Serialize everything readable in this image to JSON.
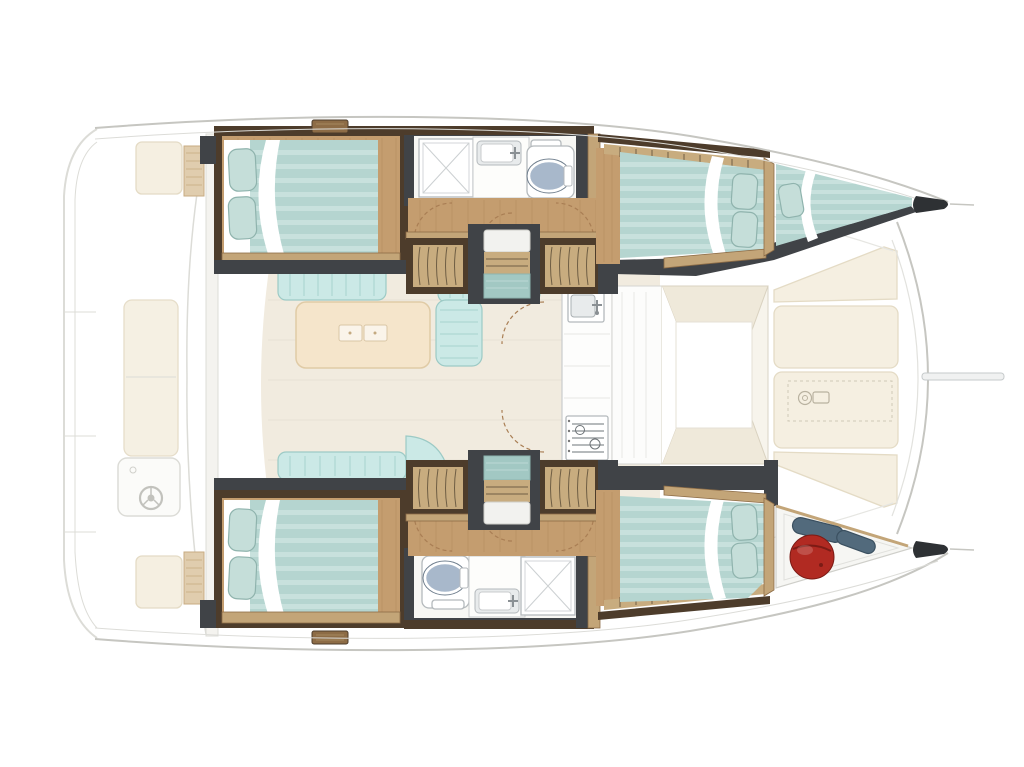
{
  "canvas": {
    "width": 1024,
    "height": 767,
    "viewBox": "0 0 1024 767",
    "background": "#ffffff"
  },
  "diagram": {
    "kind": "boat-floor-plan",
    "vessel_type": "catamaran",
    "bow_direction": "right",
    "stern_direction": "left",
    "layout": {
      "port_hull": [
        "aft-double-cabin",
        "bathroom-shower-sink-toilet",
        "stairwell",
        "forward-double-cabin",
        "bow-berth"
      ],
      "starboard_hull": [
        "aft-double-cabin",
        "bathroom-toilet-sink-shower",
        "stairwell",
        "forward-double-cabin",
        "bow-locker-with-fenders"
      ],
      "bridge_deck": [
        "aft-cockpit-benches",
        "helm-station-with-wheel",
        "salon-sofa",
        "salon-table",
        "galley-sink-and-stove",
        "forward-doorway",
        "forward-cockpit-lounge",
        "bowsprit"
      ]
    },
    "counts": {
      "double_beds": 4,
      "bow_berths": 1,
      "bathrooms": 2,
      "showers": 2,
      "toilets": 2,
      "bathroom_sinks": 2,
      "stairwells": 2,
      "fenders": 3,
      "helm_wheels": 1,
      "cockpit_benches": 3,
      "cockpit_tables": 2,
      "forward_lounge_cushions": 4,
      "salon_table_latches": 2
    }
  },
  "colors": {
    "bg": "#ffffff",
    "outline": "#c6c6c1",
    "fadedStroke": "#dcdcd7",
    "bulkheadFill": "#f4f3ef",
    "cushionCream": "#f5efe1",
    "cushionStroke": "#e4dbc5",
    "benchWood": "#e0cdae",
    "benchWoodLine": "#c7ab82",
    "woodFloor": "#c49d6f",
    "woodFloorLine": "#a87f52",
    "woodSill": "#c3a578",
    "woodTrim": "#8d6c46",
    "wallBrown": "#4d3c2b",
    "wallGray": "#404347",
    "louverBase": "#c8ac7f",
    "louverLine": "#5f5039",
    "bedTeal": "#b5d5d0",
    "bedStripe": "#cde4e0",
    "pillow": "#c5ded9",
    "pillowStroke": "#8fb3ad",
    "white": "#ffffff",
    "sofaTeal": "#cbe9e6",
    "sofaStripe": "#b0d8d4",
    "sofaStroke": "#9ccac5",
    "salonFloor": "#f1ebdf",
    "tableCream": "#f5e5cb",
    "tableStroke": "#e0cba6",
    "bathFloor": "#f7f7f4",
    "fixtureStroke": "#b4b9bc",
    "fixtureInner": "#e8ebec",
    "toiletSeat": "#a8b8cb",
    "toiletRing": "#6f7e8d",
    "tealLanding": "#a2c8c3",
    "tipDark": "#2e3134",
    "fenderRed": "#b12a22",
    "fenderRedDark": "#7c1b15",
    "fenderBlue": "#526a7c",
    "fenderBlueDark": "#3b5060",
    "doorArc": "#a97e54",
    "doorwayCream": "#efe9da",
    "doorwayStroke": "#d9d2c0"
  }
}
